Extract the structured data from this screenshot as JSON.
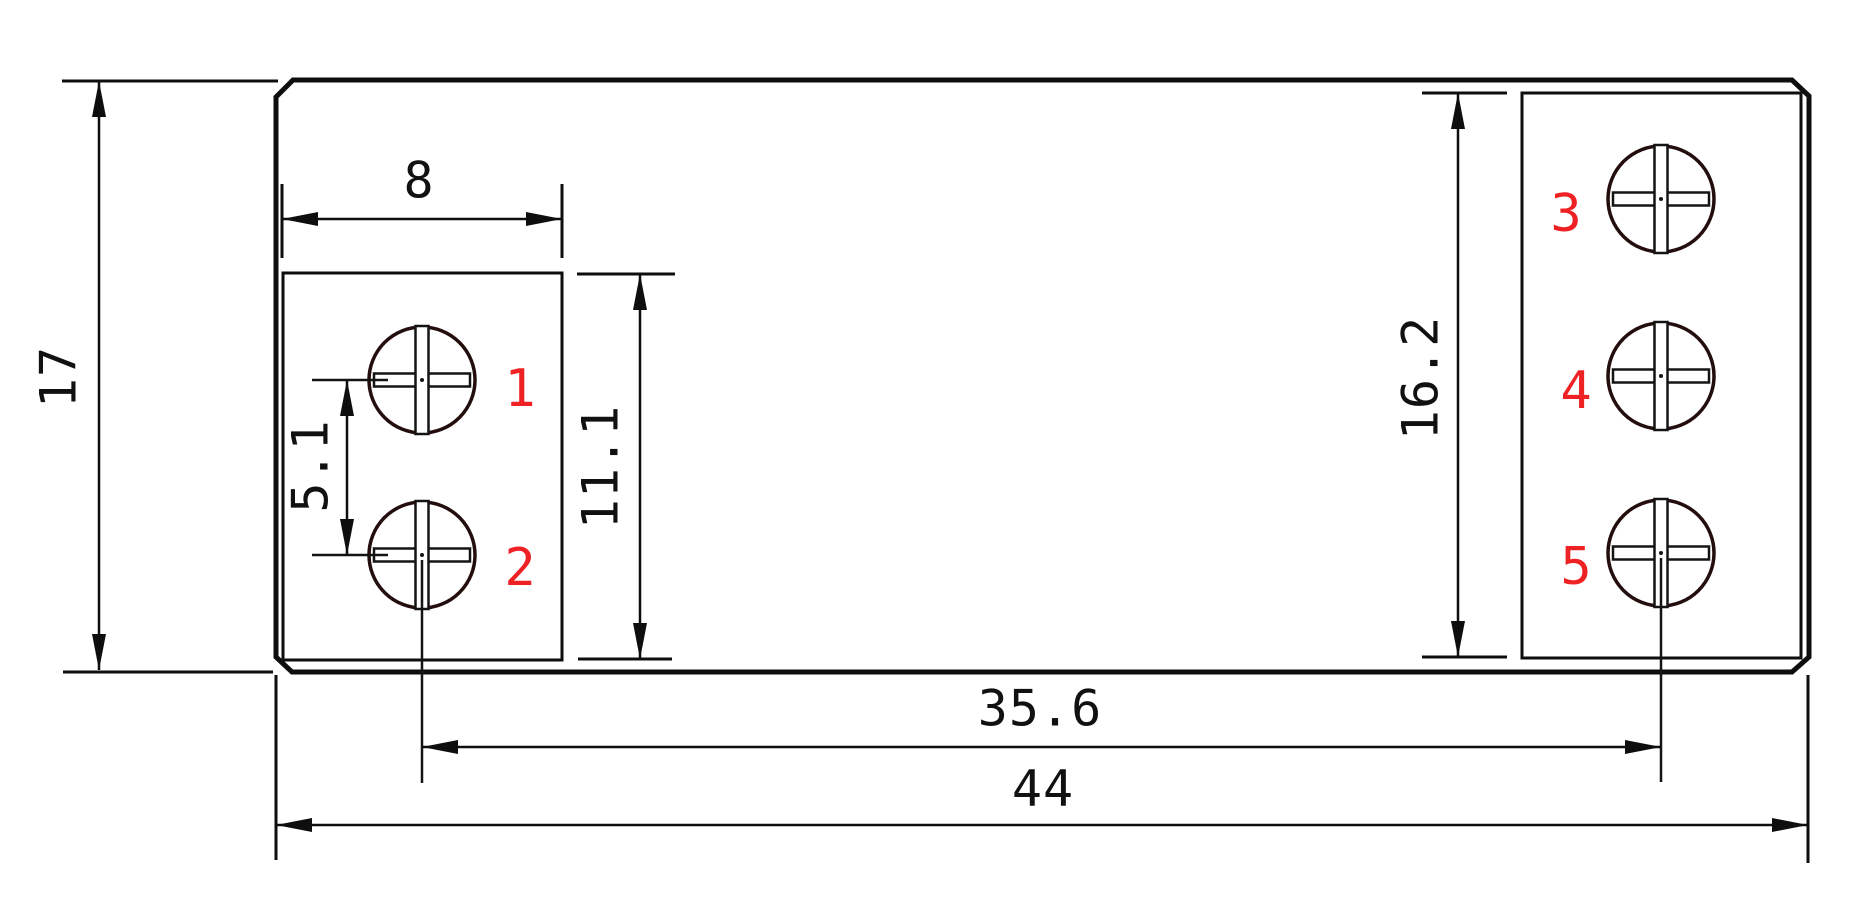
{
  "drawing": {
    "dimensions": {
      "overall_width": "44",
      "overall_height": "17",
      "screw_center_span": "35.6",
      "left_block_width": "8",
      "left_screw_pitch": "5.1",
      "left_block_height": "11.1",
      "right_block_height": "16.2"
    },
    "terminal_labels": [
      "1",
      "2",
      "3",
      "4",
      "5"
    ],
    "colors": {
      "line": "#0e0e0e",
      "label_red": "#ee2224",
      "background": "#ffffff"
    }
  }
}
